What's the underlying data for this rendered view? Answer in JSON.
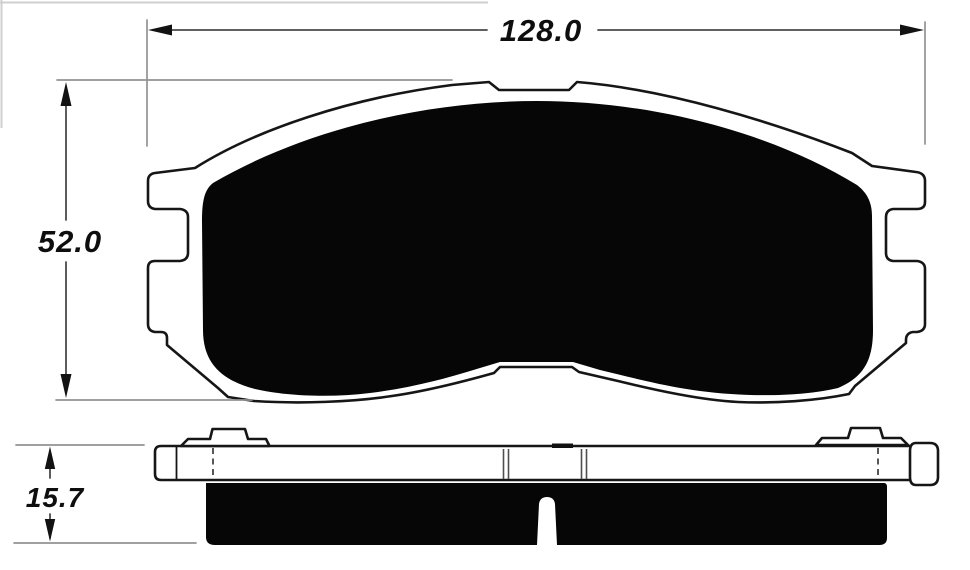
{
  "drawing": {
    "type": "brake-pad-technical-drawing",
    "views": [
      "front-view",
      "side-view"
    ],
    "dimensions": {
      "width_mm": "128.0",
      "height_mm": "52.0",
      "thickness_mm": "15.7"
    },
    "colors": {
      "background": "#ffffff",
      "ink": "#161616",
      "friction_fill": "#060606",
      "extension_line": "#929292",
      "dimension_line": "#4a4a4a",
      "label_color": "#0e0e0e"
    }
  }
}
